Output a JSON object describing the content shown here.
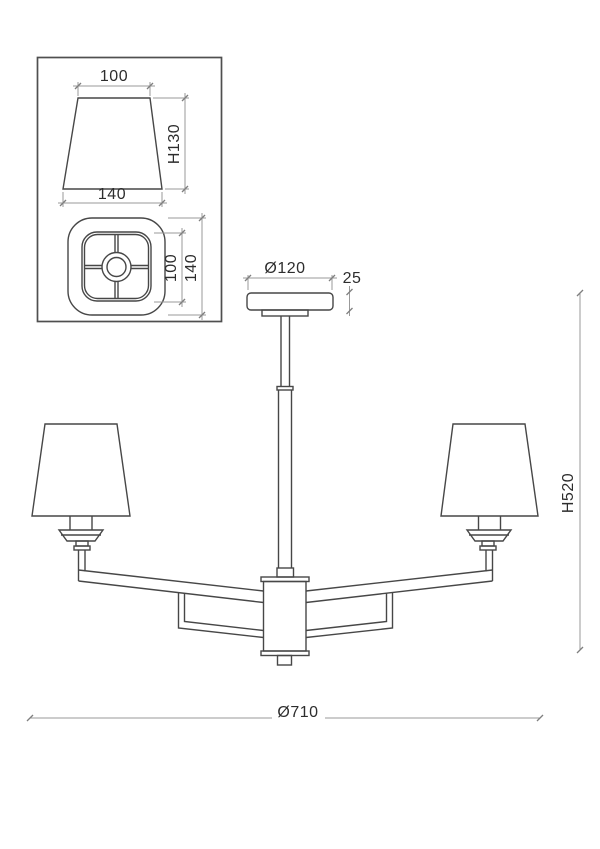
{
  "drawing": {
    "inset": {
      "front_view": {
        "top_width": "100",
        "height": "H130",
        "bottom_width": "140"
      },
      "top_view": {
        "inner_size": "100",
        "outer_size": "140"
      }
    },
    "main_view": {
      "canopy_diameter": "Ø120",
      "canopy_height": "25",
      "overall_diameter": "Ø710",
      "overall_height": "H520"
    }
  }
}
